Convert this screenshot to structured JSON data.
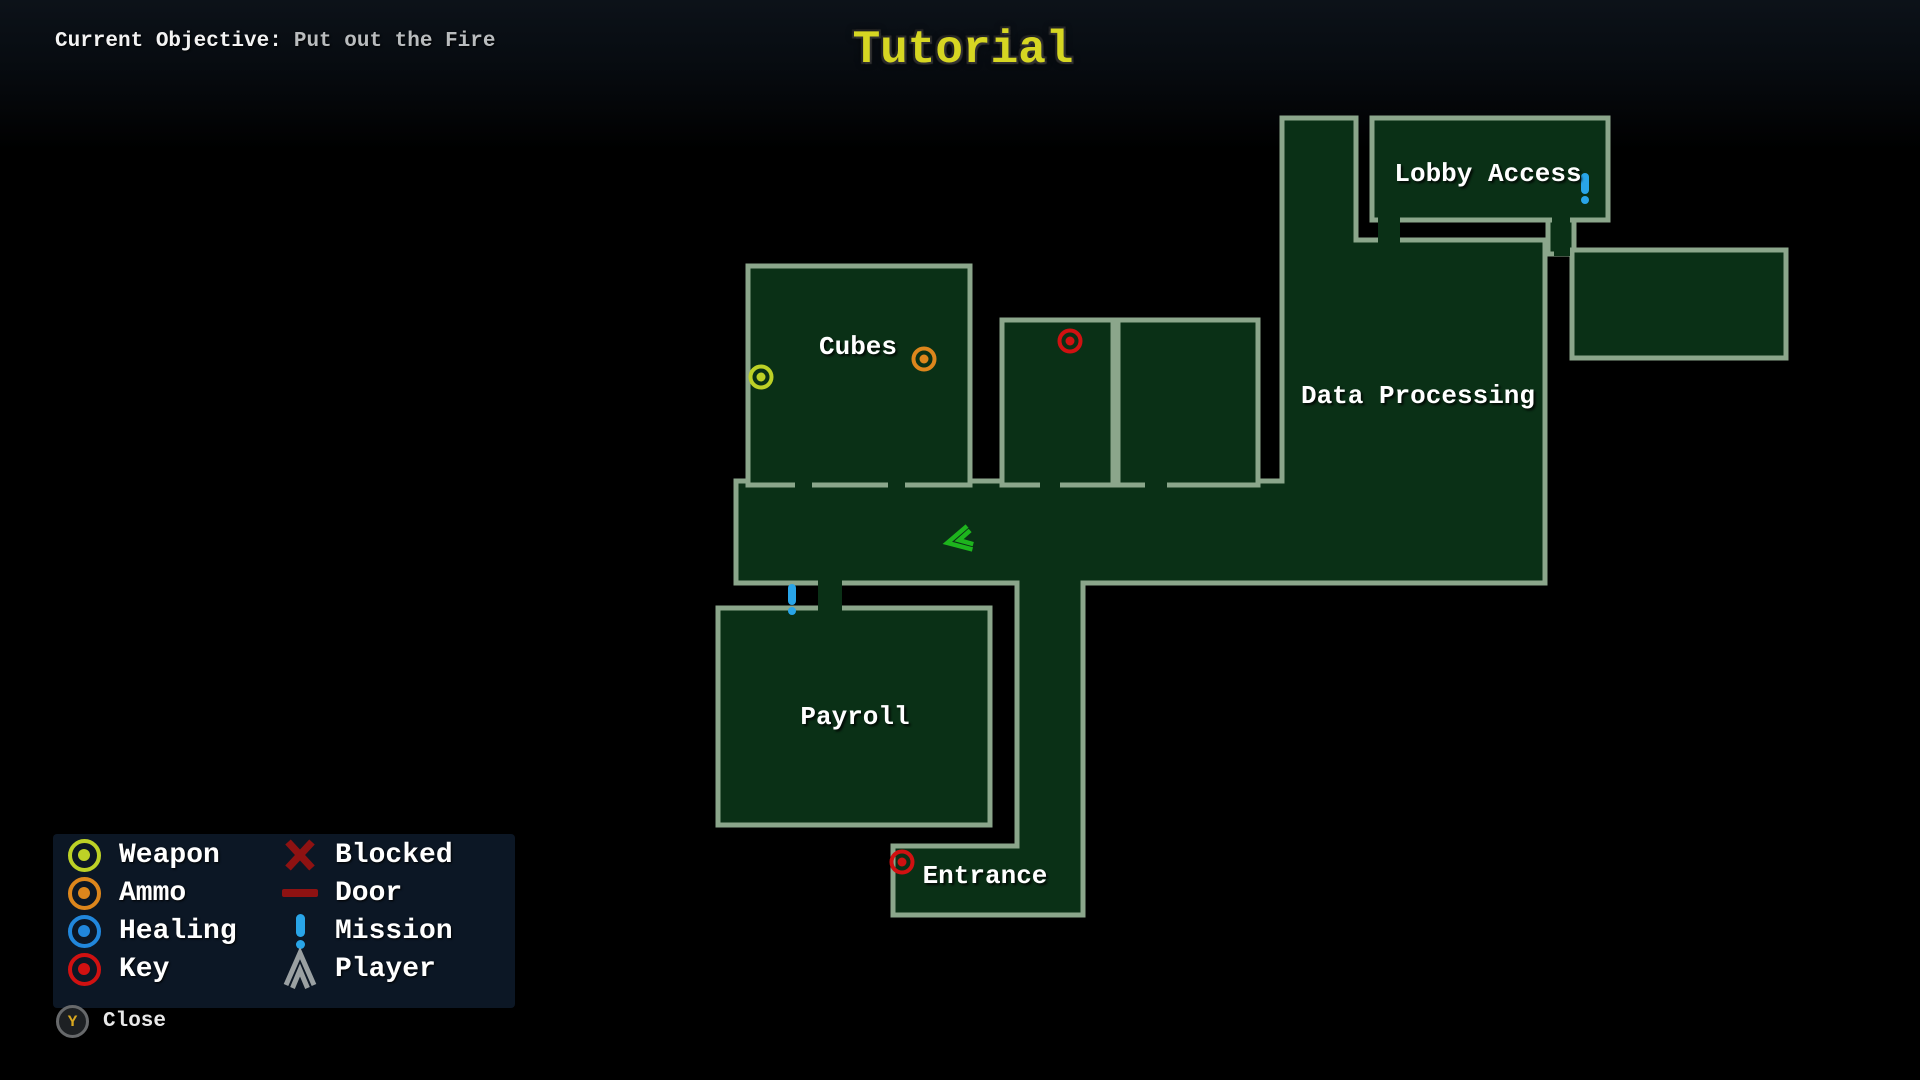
{
  "hud": {
    "objective_label": "Current Objective:",
    "objective_value": "Put out the Fire",
    "title": "Tutorial"
  },
  "map": {
    "rooms": {
      "cubes": {
        "label": "Cubes"
      },
      "payroll": {
        "label": "Payroll"
      },
      "entrance": {
        "label": "Entrance"
      },
      "data_processing": {
        "label": "Data Processing"
      },
      "lobby_access": {
        "label": "Lobby Access"
      }
    },
    "markers": {
      "cubes_weapon": "weapon",
      "cubes_ammo": "ammo",
      "storage_room_key": "key",
      "entrance_key": "key",
      "lobby_access_mission": "mission",
      "payroll_mission": "mission",
      "player": "player"
    }
  },
  "legend": {
    "items": [
      {
        "id": "weapon",
        "label": "Weapon"
      },
      {
        "id": "ammo",
        "label": "Ammo"
      },
      {
        "id": "healing",
        "label": "Healing"
      },
      {
        "id": "key",
        "label": "Key"
      },
      {
        "id": "blocked",
        "label": "Blocked"
      },
      {
        "id": "door",
        "label": "Door"
      },
      {
        "id": "mission",
        "label": "Mission"
      },
      {
        "id": "player",
        "label": "Player"
      }
    ]
  },
  "controls": {
    "close_button_key": "Y",
    "close_label": "Close"
  },
  "colors": {
    "weapon": "#bdd126",
    "ammo": "#dd861c",
    "healing": "#2187dc",
    "key": "#d01111",
    "blocked": "#8e1212",
    "door": "#8e1212",
    "mission": "#29a5e8",
    "player_legend": "#9aa0a2",
    "player_map": "#1db41d",
    "room_fill": "#0a3016",
    "room_border": "#8ba68b",
    "title": "#d6d622",
    "label": "#ffffff",
    "panel": "#0d1826"
  }
}
